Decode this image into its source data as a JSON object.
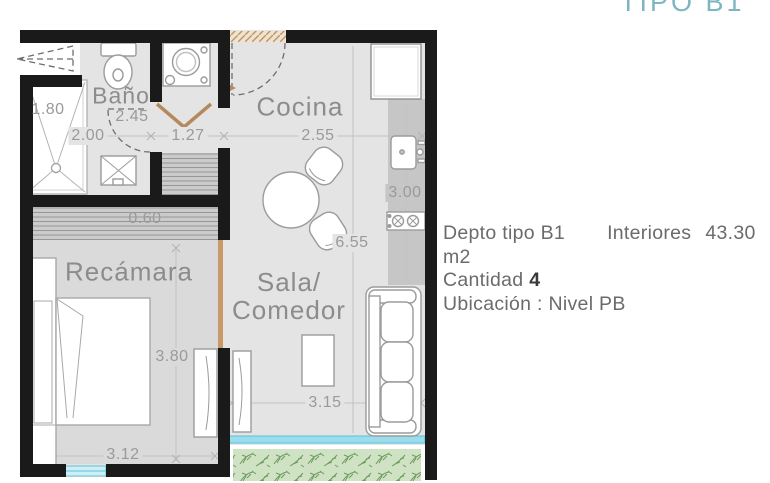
{
  "title": "TIPO B1",
  "info": {
    "depto": "Depto tipo B1",
    "interiores_label": "Interiores",
    "interiores_value": "43.30 m2",
    "cantidad_label": "Cantidad",
    "cantidad_value": "4",
    "ubicacion": "Ubicación : Nivel PB"
  },
  "rooms": {
    "bano": "Baño",
    "cocina": "Cocina",
    "recamara": "Recámara",
    "sala_line1": "Sala/",
    "sala_line2": "Comedor"
  },
  "dimensions": {
    "shower_width": "1.80",
    "bath_width": "2.00",
    "bath_length": "2.45",
    "laundry_width": "1.27",
    "kitchen_width": "2.55",
    "kitchen_length": "3.00",
    "interior_length": "6.55",
    "closet_depth": "0.60",
    "bedroom_length": "3.80",
    "living_width": "3.15",
    "bedroom_width": "3.12"
  },
  "colors": {
    "accent_teal": "#7db6c2",
    "wall": "#1a1a1a",
    "floor": "#e4e4e4",
    "bedroom_floor": "#dadada",
    "counter": "#c6c6c6",
    "window": "#8ed4e6",
    "garden": "#cfe2c3",
    "wood_door": "#b5895c"
  }
}
